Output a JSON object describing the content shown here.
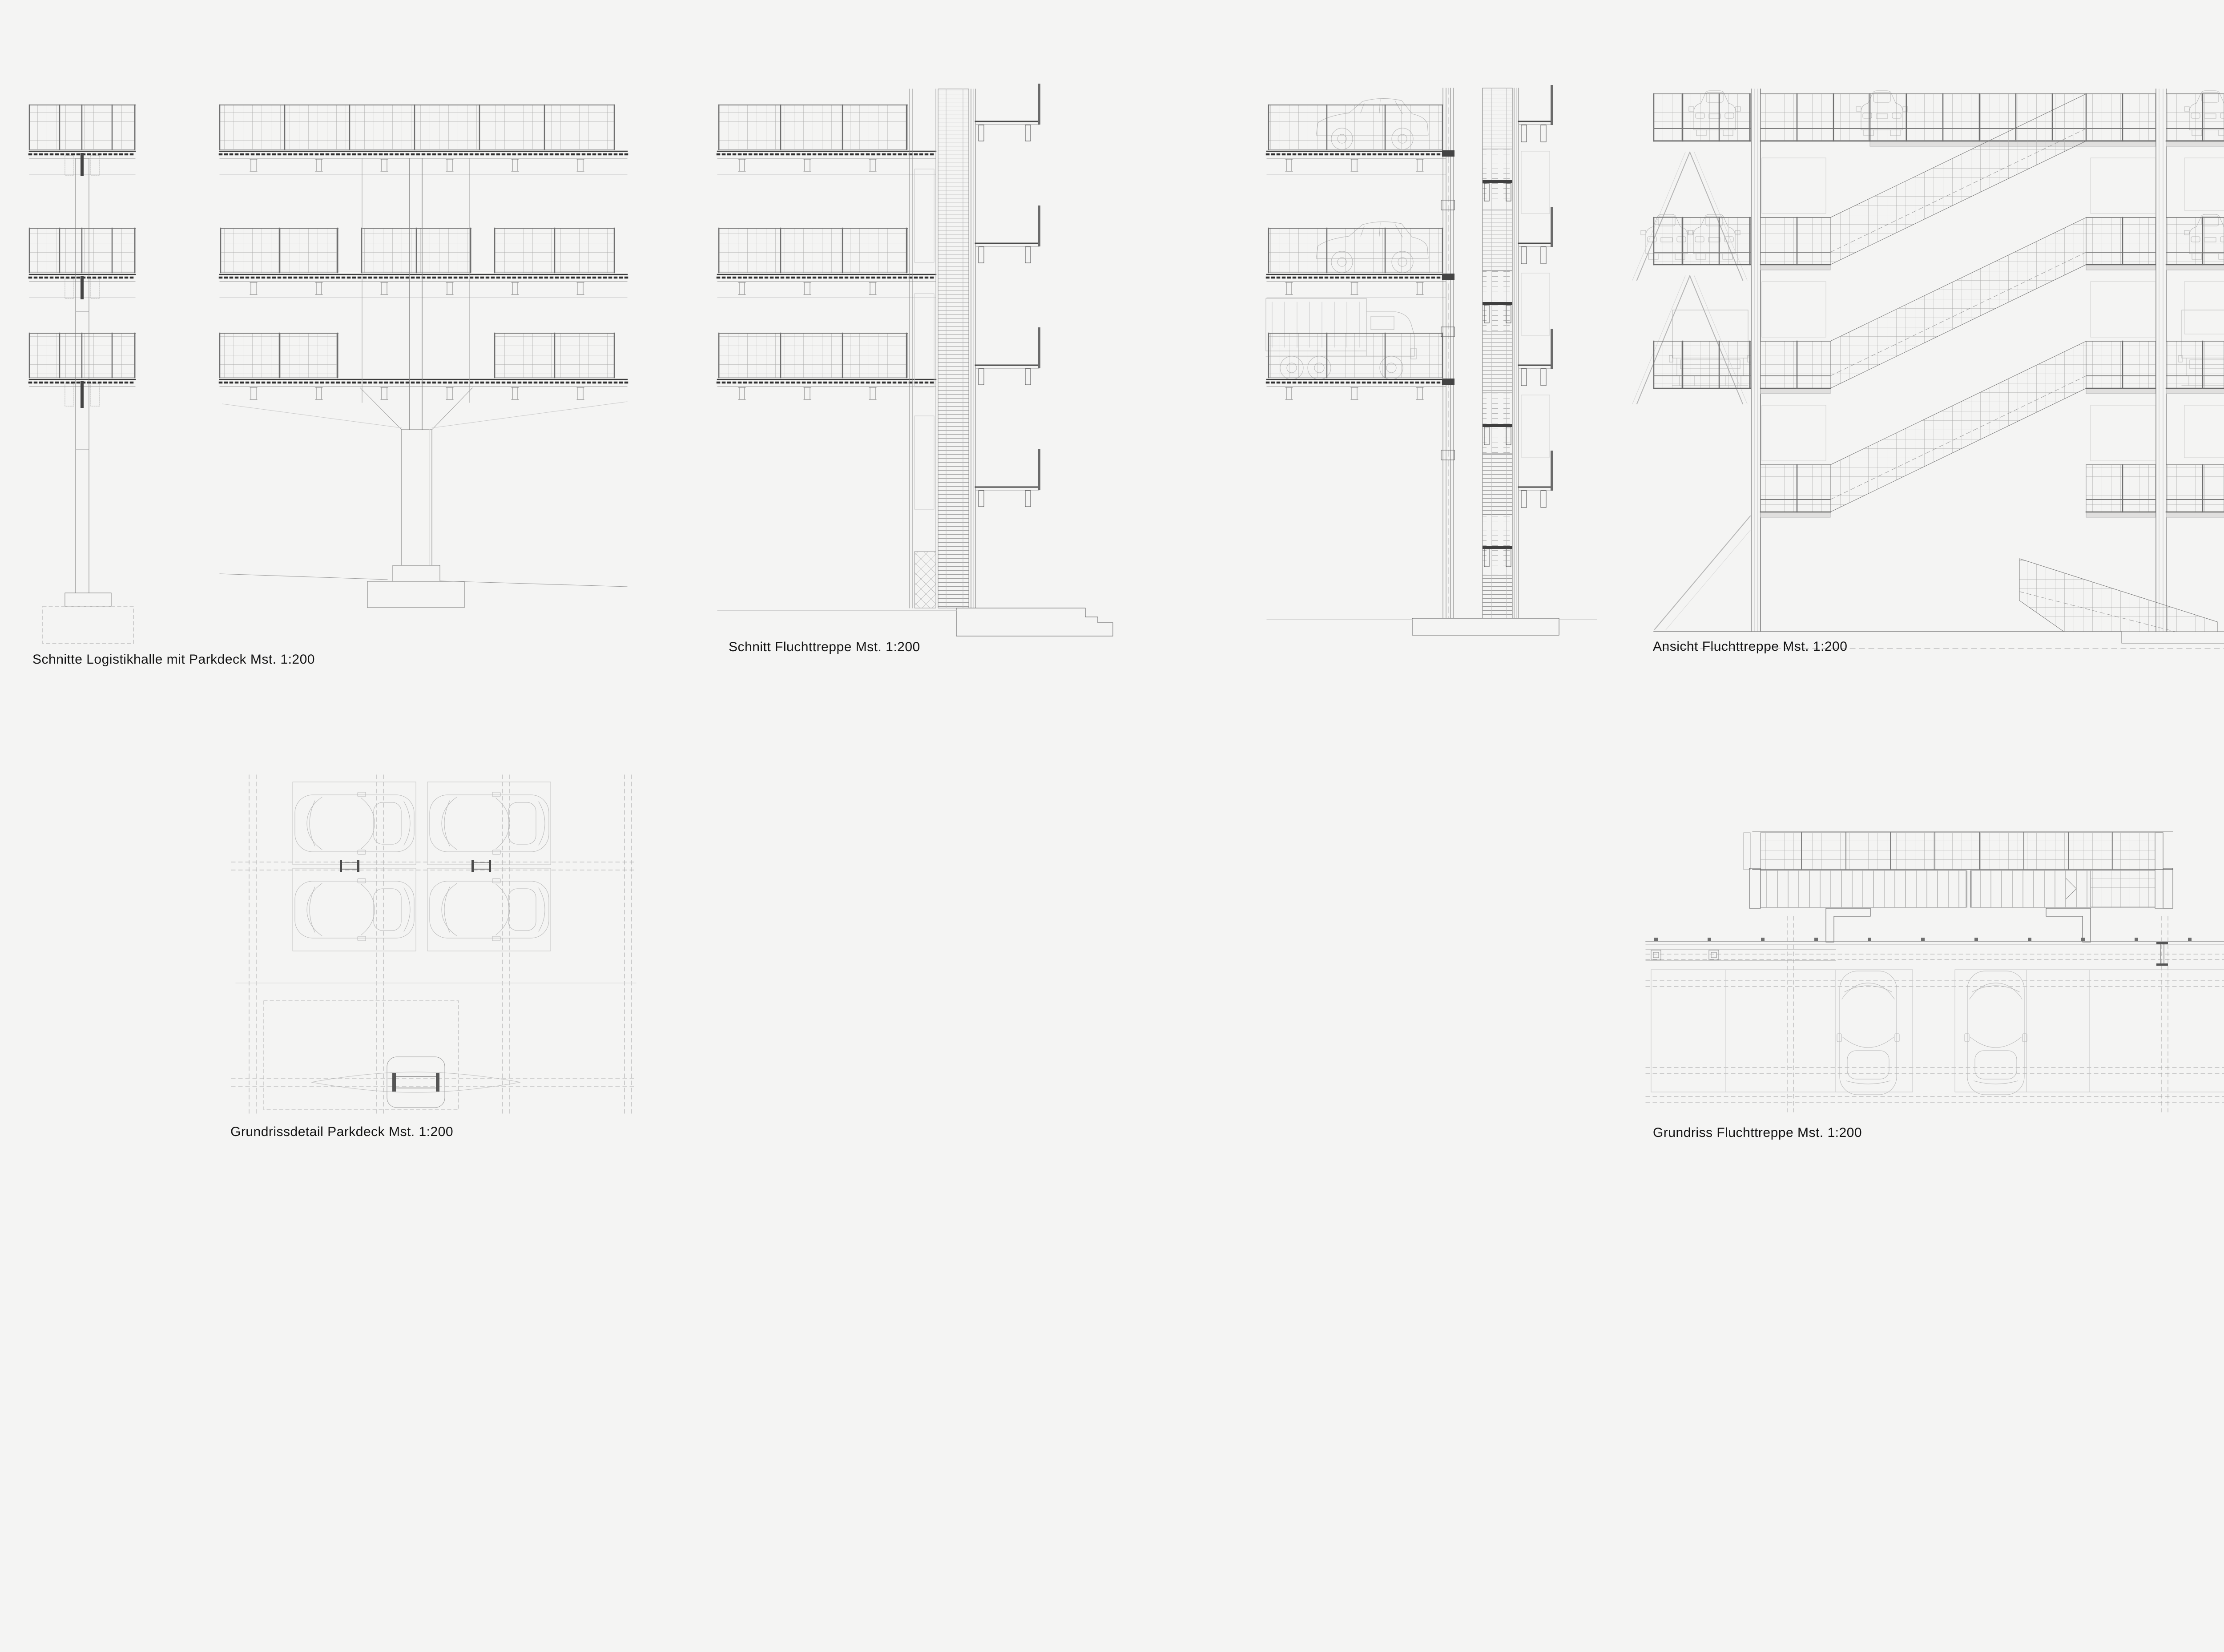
{
  "sheet": {
    "background": "#f4f4f3",
    "line_color": "#8c8c8c",
    "dark_line_color": "#3c3c3c",
    "light_line_color": "#c9c9c9",
    "vehicle_line_color": "#b6b6b6",
    "text_color": "#141414",
    "scale": "1:200"
  },
  "figures": [
    {
      "id": "schnitte-logistikhalle",
      "caption": "Schnitte Logistikhalle mit Parkdeck Mst. 1:200"
    },
    {
      "id": "schnitt-fluchttreppe",
      "caption": "Schnitt Fluchttreppe Mst. 1:200"
    },
    {
      "id": "ansicht-fluchttreppe",
      "caption": "Ansicht Fluchttreppe Mst. 1:200"
    },
    {
      "id": "grundrissdetail-parkdeck",
      "caption": "Grundrissdetail Parkdeck Mst. 1:200"
    },
    {
      "id": "grundriss-fluchttreppe",
      "caption": "Grundriss Fluchttreppe Mst. 1:200"
    }
  ]
}
